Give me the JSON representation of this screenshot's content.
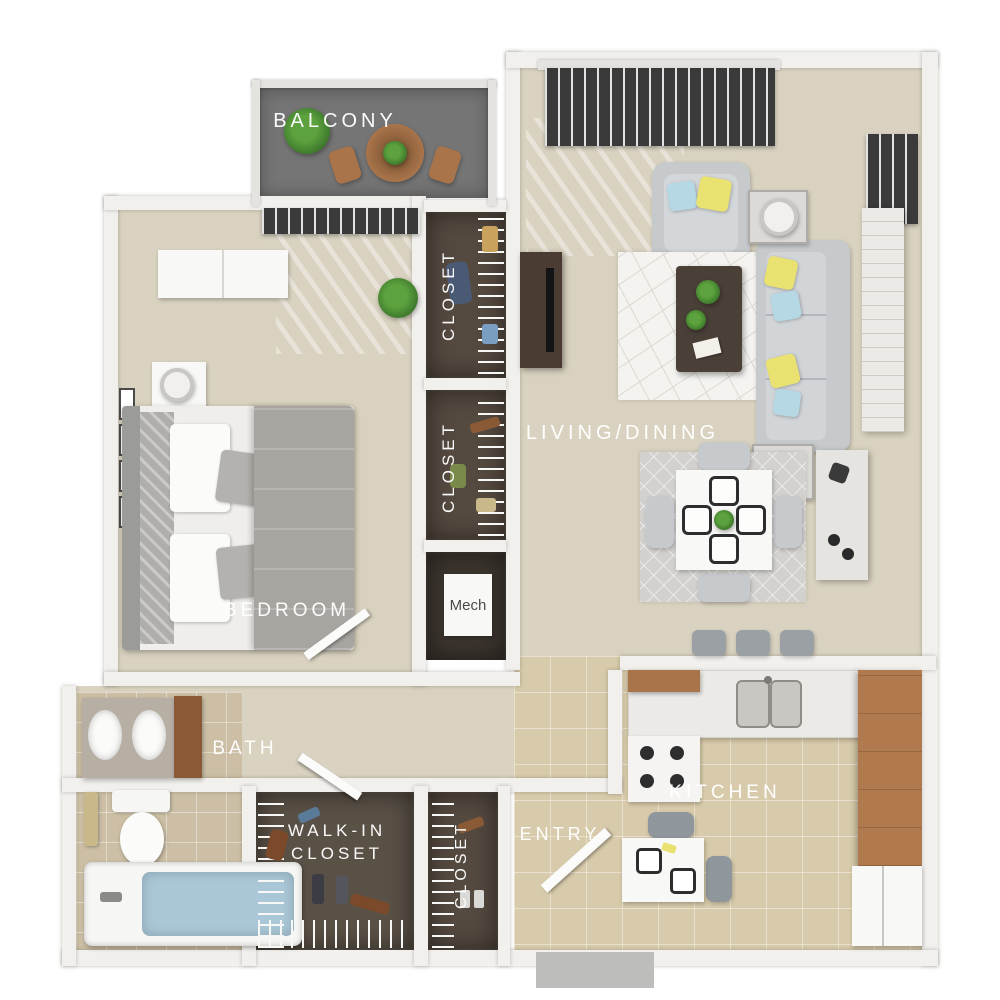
{
  "image_type": "3D apartment floor plan render, top-down view",
  "labels": {
    "balcony": "BALCONY",
    "closet_upper": "CLOSET",
    "closet_lower": "CLOSET",
    "living_dining": "LIVING/DINING",
    "bedroom": "BEDROOM",
    "mech": "Mech",
    "bath": "BATH",
    "walk_in_closet": "WALK-IN CLOSET",
    "entry_closet": "CLOSET",
    "entry": "ENTRY",
    "kitchen": "KITCHEN"
  },
  "colors": {
    "background": "#ffffff",
    "walls": "#f2f0ed",
    "carpet": "#d9d2c0",
    "kitchen_tile": "#d8cbab",
    "bath_tile": "#ccbfa5",
    "balcony_floor": "#757575",
    "closet_interior": "#554a40",
    "label_text": "#ffffff",
    "cabinet_wood": "#a9744a",
    "sofa_gray": "#c6cacd",
    "accent_pillow_yellow": "#e9e170",
    "accent_pillow_blue": "#b5d8e4",
    "bath_water": "#a9c7d6"
  },
  "furniture": [
    "patio table",
    "patio chairs",
    "potted plants",
    "dresser",
    "bed",
    "nightstands",
    "table lamps",
    "wall art frames",
    "armchair",
    "sofa",
    "coffee table",
    "end tables",
    "area rugs",
    "tv stand",
    "dining table",
    "dining chairs",
    "sideboard",
    "bar stools",
    "range",
    "kitchen sink",
    "refrigerator",
    "breakfast table",
    "double vanity",
    "toilet",
    "bathtub",
    "wire shelving",
    "sliding glass doors with blinds",
    "entry door"
  ]
}
